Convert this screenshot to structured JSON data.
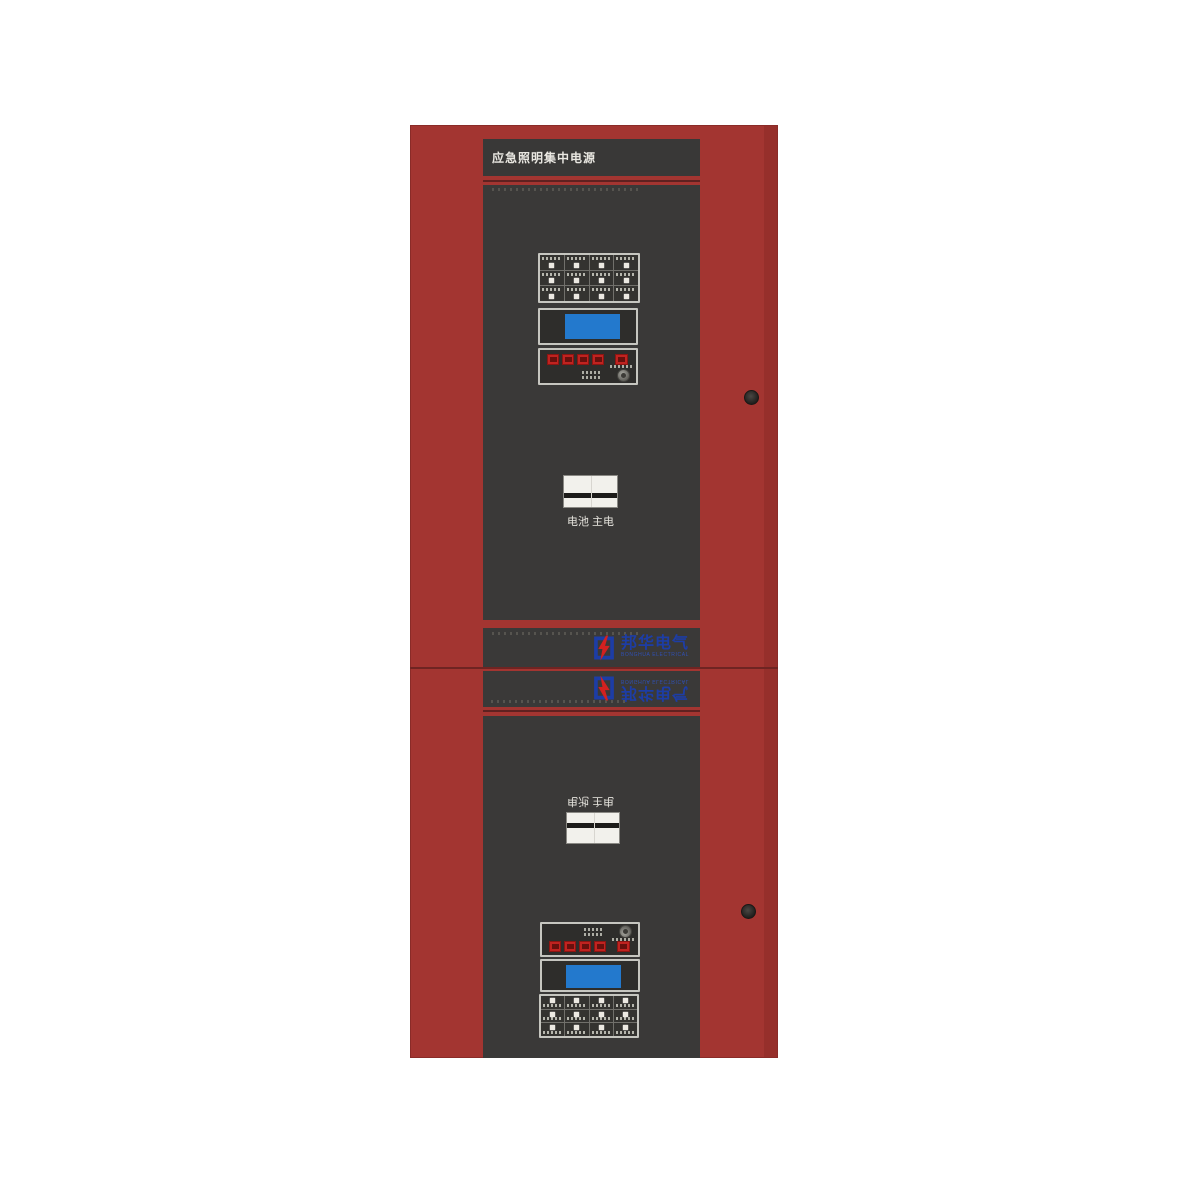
{
  "cabinet": {
    "title": "应急照明集中电源",
    "colors": {
      "body_red": "#a33531",
      "panel_dark": "#3a3938",
      "lcd_blue": "#2379cd",
      "button_red": "#c02320",
      "logo_blue": "#1d3da6",
      "bolt_red": "#d2211f",
      "rocker_white": "#f2f1ec"
    }
  },
  "logo": {
    "cn": "邦华电气",
    "en": "BONGHUA ELECTRICAL"
  },
  "upper_section": {
    "switch_label": "电池 主电",
    "indicator_count": 12,
    "button_count": 4
  },
  "lower_section": {
    "switch_label": "电池 主电",
    "indicator_count": 12,
    "button_count": 4
  }
}
